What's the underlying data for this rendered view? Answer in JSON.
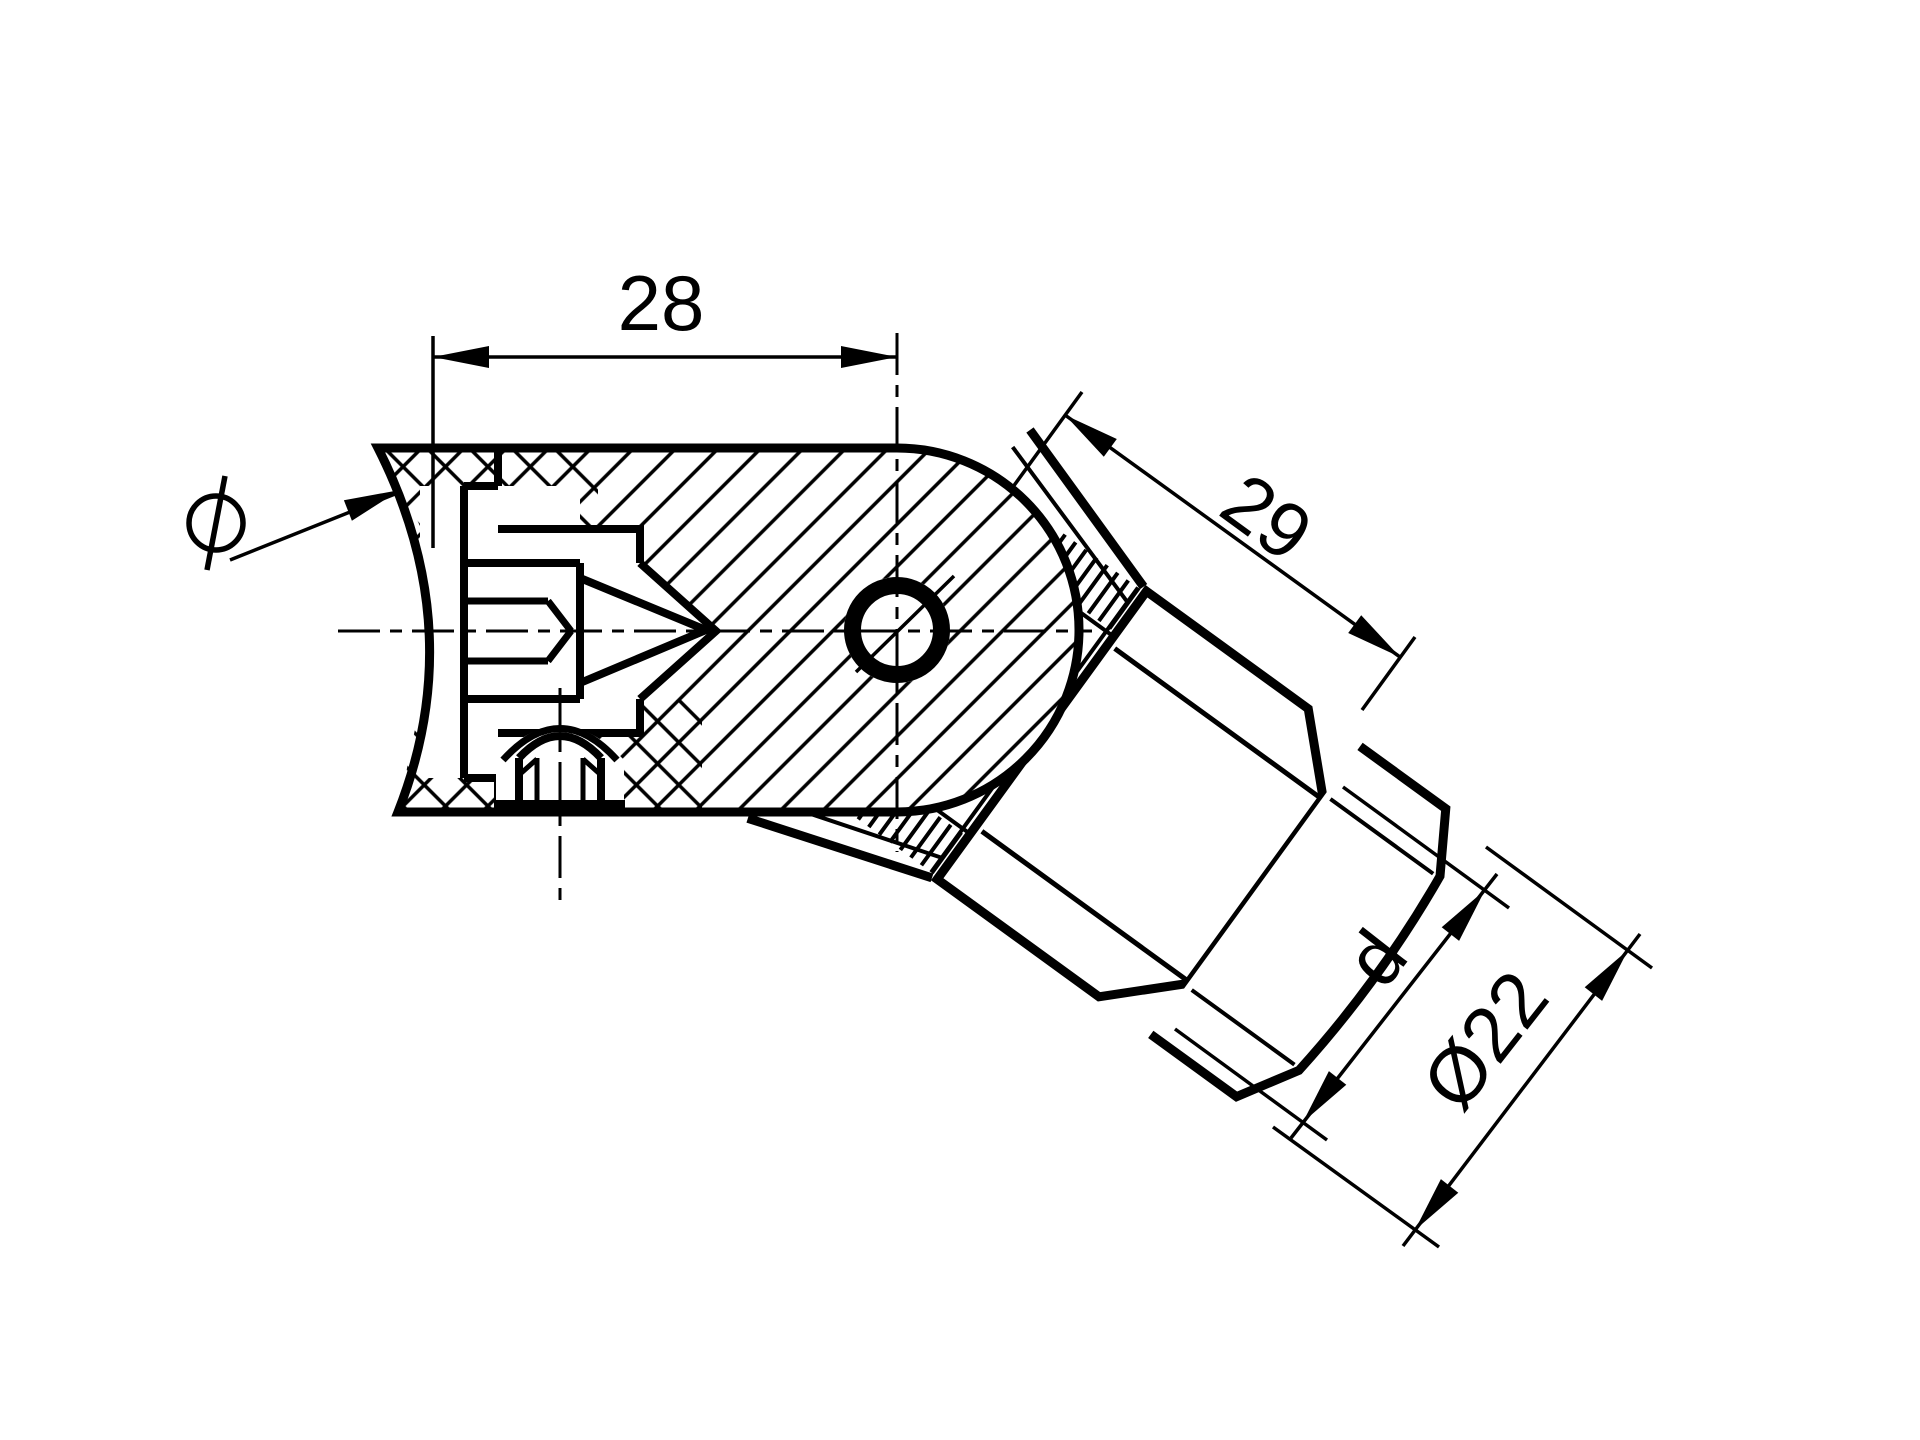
{
  "title": "Technical section drawing of adjustable swivel connector",
  "colors": {
    "line": "#000000",
    "background": "#ffffff"
  },
  "dimensions": {
    "horizontal_width": {
      "label": "28"
    },
    "arm_length": {
      "label": "29"
    },
    "thread_diameter": {
      "label": "d"
    },
    "tube_diameter": {
      "label": "Ø22"
    },
    "leader_symbol": "Ø"
  }
}
